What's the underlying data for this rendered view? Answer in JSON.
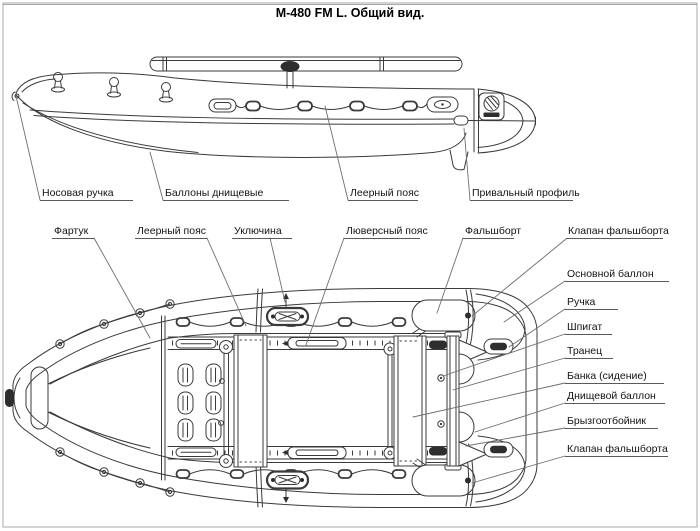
{
  "title": "М-480 FM L. Общий вид.",
  "labels": {
    "side_view": {
      "bow_handle": "Носовая ручка",
      "bottom_cylinders": "Баллоны днищевые",
      "rail_belt": "Леерный пояс",
      "rub_rail_profile": "Привальный профиль"
    },
    "top_view": {
      "apron": "Фартук",
      "rail_belt": "Леерный пояс",
      "oarlock": "Уключина",
      "grommet_belt": "Люверсный пояс",
      "bulwark": "Фальшборт",
      "bulwark_valve_top": "Клапан фальшборта",
      "main_cylinder": "Основной баллон",
      "handle": "Ручка",
      "scupper": "Шпигат",
      "transom": "Транец",
      "bench_seat": "Банка (сидение)",
      "bottom_cylinder": "Днищевой баллон",
      "spray_deflector": "Брызгоотбойник",
      "bulwark_valve_bottom": "Клапан фальшборта"
    }
  },
  "colors": {
    "line": "#3a3a3a",
    "label": "#141414",
    "leader": "#6e6e6e",
    "frame": "#a9a9a9"
  }
}
